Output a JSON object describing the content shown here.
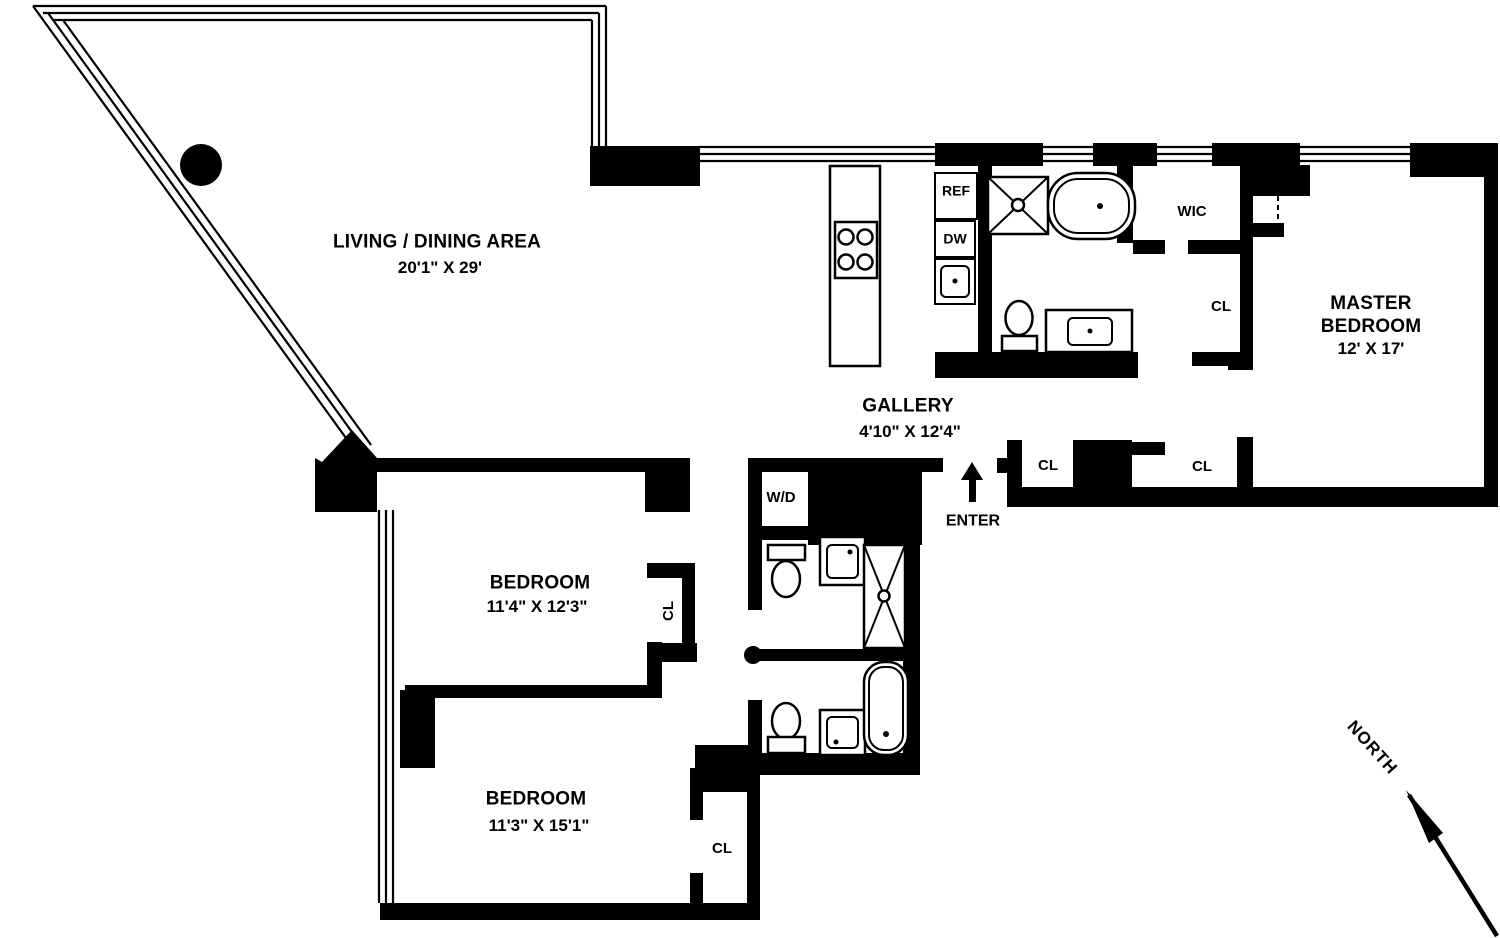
{
  "plan": {
    "rooms": {
      "living": {
        "name": "LIVING / DINING AREA",
        "dims": "20'1\" X 29'"
      },
      "gallery": {
        "name": "GALLERY",
        "dims": "4'10\" X 12'4\""
      },
      "master": {
        "name": "MASTER BEDROOM",
        "dims": "12' X 17'"
      },
      "bedroom1": {
        "name": "BEDROOM",
        "dims": "11'4\" X 12'3\""
      },
      "bedroom2": {
        "name": "BEDROOM",
        "dims": "11'3\" X 15'1\""
      }
    },
    "labels": {
      "wic": "WIC",
      "closet": "CL",
      "washer_dryer": "W/D",
      "refrigerator": "REF",
      "dishwasher": "DW",
      "enter": "ENTER",
      "north": "NORTH"
    },
    "colors": {
      "wall": "#000000",
      "background": "#ffffff"
    }
  }
}
